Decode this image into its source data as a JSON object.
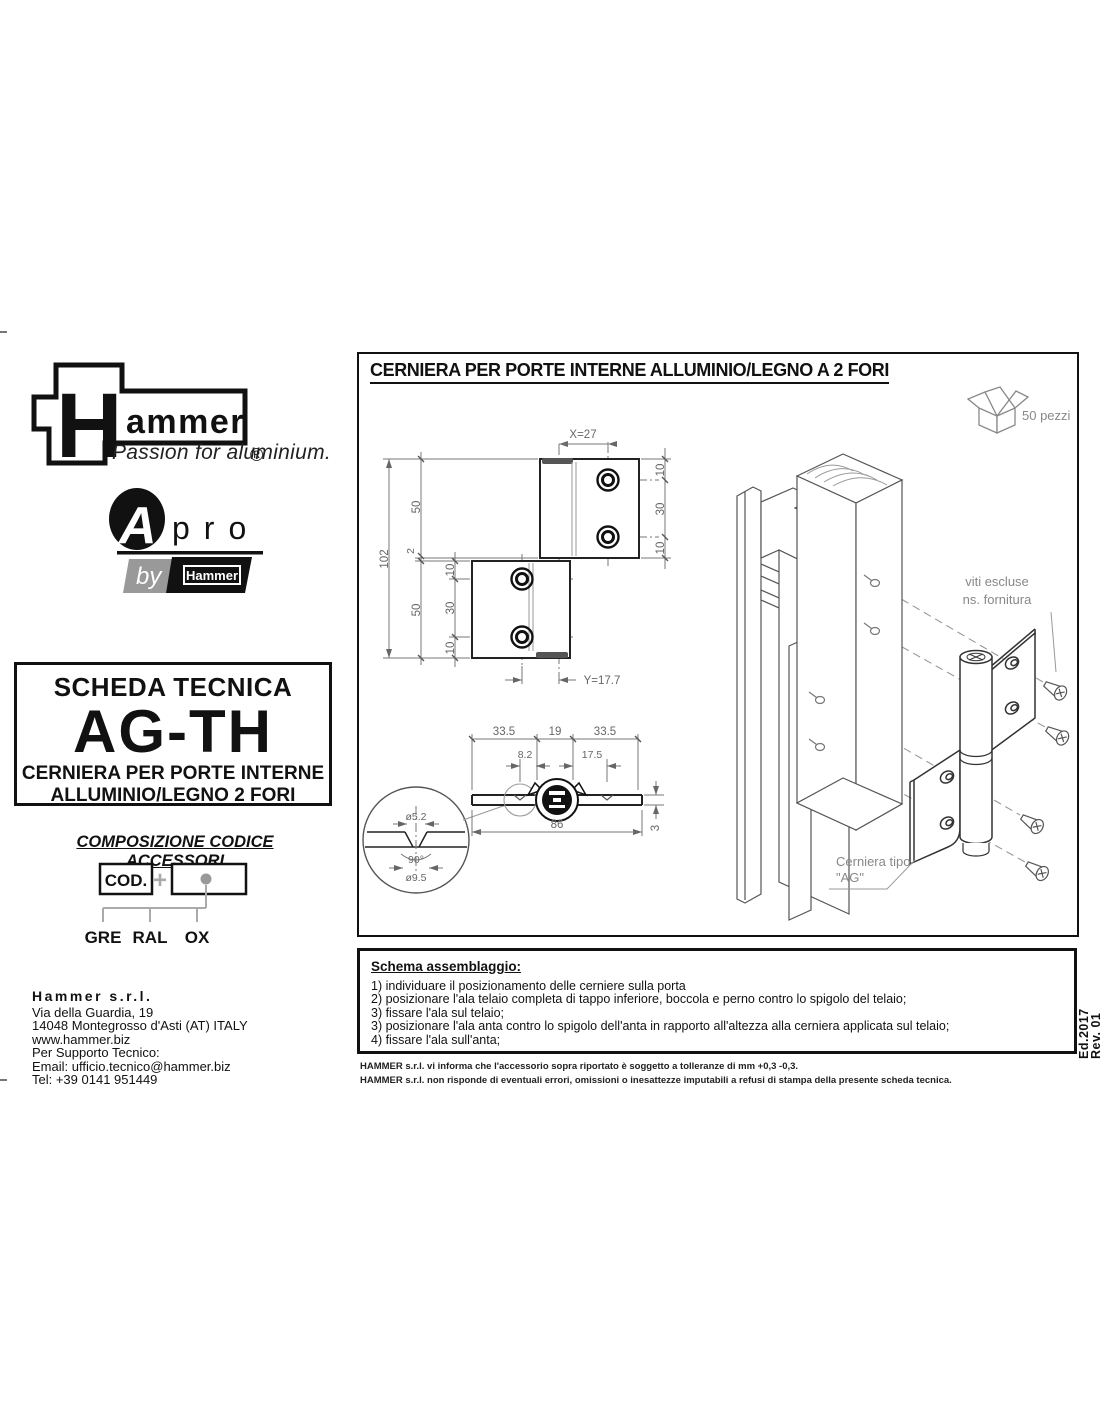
{
  "branding": {
    "logo": "Hammer",
    "registered": "®",
    "tagline": "Passion for aluminium.",
    "apro": {
      "a": "A",
      "pro": "pro",
      "by": "by",
      "by_logo": "Hammer"
    }
  },
  "datasheet": {
    "header": "SCHEDA TECNICA",
    "code": "AG-TH",
    "product_line1": "CERNIERA PER PORTE INTERNE",
    "product_line2": "ALLUMINIO/LEGNO 2 FORI"
  },
  "code_composition": {
    "title": "COMPOSIZIONE CODICE ACCESSORI",
    "cod": "COD.",
    "plus": "+",
    "finishes": [
      "GRE",
      "RAL",
      "OX"
    ]
  },
  "company": {
    "name": "Hammer s.r.l.",
    "street": "Via della Guardia, 19",
    "city": "14048 Montegrosso d'Asti (AT) ITALY",
    "website": "www.hammer.biz",
    "support": "Per Supporto Tecnico:",
    "email": "Email: ufficio.tecnico@hammer.biz",
    "phone": "Tel: +39 0141 951449"
  },
  "drawing": {
    "title": "CERNIERA PER PORTE INTERNE ALLUMINIO/LEGNO A 2 FORI",
    "package_qty": "50 pezzi",
    "front_dims": {
      "x": "X=27",
      "total": "102",
      "upper": "50",
      "gap": "2",
      "lower": "50",
      "left_chain": [
        "10",
        "30",
        "10"
      ],
      "right_chain": [
        "10",
        "30",
        "10"
      ],
      "y": "Y=17.7"
    },
    "section_dims": {
      "left": "33.5",
      "center": "19",
      "right": "33.5",
      "offset1": "8.2",
      "offset2": "17.5",
      "total": "86",
      "thickness": "3",
      "hole_dia": "ø5.2",
      "angle": "90°",
      "head_dia": "ø9.5"
    },
    "labels": {
      "screws_line1": "viti escluse",
      "screws_line2": "ns. fornitura",
      "hinge_line1": "Cerniera tipo",
      "hinge_line2": "\"AG\""
    }
  },
  "assembly": {
    "title": "Schema assemblaggio:",
    "steps": [
      "1) individuare il posizionamento delle cerniere sulla porta",
      "2) posizionare l'ala telaio completa di tappo inferiore, boccola e perno contro lo spigolo del telaio;",
      "3) fissare l'ala sul telaio;",
      "3) posizionare l'ala anta contro lo spigolo dell'anta in rapporto all'altezza alla cerniera applicata sul telaio;",
      "4) fissare l'ala sull'anta;"
    ]
  },
  "disclaimer": [
    "HAMMER s.r.l. vi informa che l'accessorio sopra riportato è soggetto a tolleranze di mm +0,3 -0,3.",
    "HAMMER s.r.l. non risponde di eventuali errori, omissioni o inesattezze imputabili a refusi di stampa della presente scheda tecnica."
  ],
  "edition": {
    "ed": "Ed.2017",
    "rev": "Rev. 01"
  }
}
